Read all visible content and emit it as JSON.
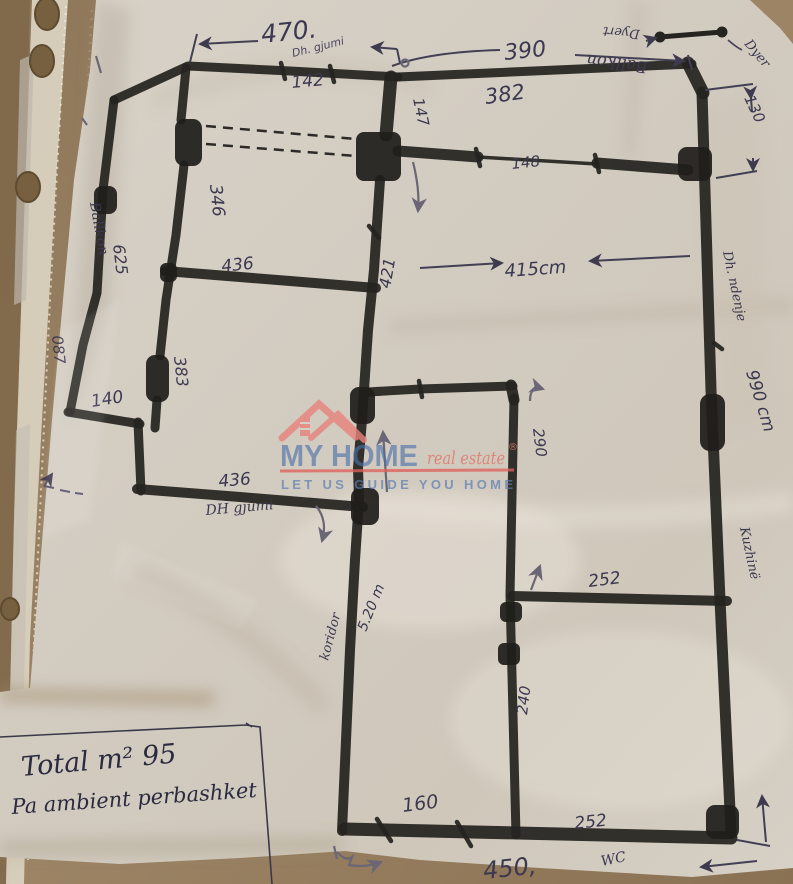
{
  "photo": {
    "note_line1": "Total m² 95",
    "note_line2": "Pa ambient perbashket"
  },
  "watermark": {
    "brand_primary": "MY HOME",
    "brand_secondary": "real estate",
    "registered": "®",
    "tagline": "LET US GUIDE YOU HOME",
    "brand_blue": "#4a70aa",
    "brand_salmon": "#e8837a",
    "underline_red": "#de625c"
  },
  "plan": {
    "rooms": {
      "balcony_left": "Ballkon",
      "balcony_top": "Ballkon",
      "bedroom_top": "Dh. gjumi",
      "bedroom_left": "DH gjumi",
      "living": "Dh. ndenje",
      "kitchen": "Kuzhinë",
      "corridor": "koridor",
      "wc": "WC"
    },
    "dims": {
      "top": "470.",
      "top_window": "142",
      "balcony_top_width": "390",
      "balcony_top_inner": "382",
      "entry_stub": "147",
      "balcony_opening": "148",
      "balcony_right_depth": "130",
      "bedroom_top_height": "346",
      "balcony_left_length": "625",
      "bedroom_top_width": "436",
      "living_left_height": "421",
      "living_width": "415cm",
      "balcony_left_depth": "087",
      "left_step": "140",
      "bedroom_left_height": "383",
      "bedroom_left_width": "436",
      "living_ext": "290",
      "right_wall_total": "990 cm",
      "kitchen_top": "252",
      "kitchen_left": "240",
      "corridor_length": "5.20 m",
      "wc_width": "160",
      "kitchen_bottom": "252",
      "bottom_total": "450,"
    },
    "legend": {
      "doors_label": "Dyert",
      "door_label": "Dyer"
    }
  }
}
